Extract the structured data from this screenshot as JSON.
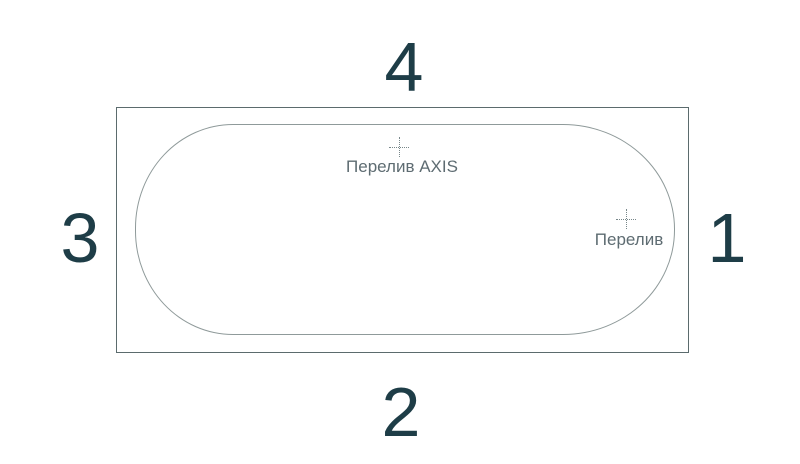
{
  "diagram": {
    "title": "bathtub top view with overflow positions",
    "sides": {
      "top": "4",
      "right": "1",
      "bottom": "2",
      "left": "3"
    },
    "markers": {
      "axis": {
        "label": "Перелив AXIS"
      },
      "standard": {
        "label": "Перелив"
      }
    },
    "colors": {
      "background": "#ffffff",
      "rim_outline": "#5b6b6d",
      "basin_outline": "#8f9a9a",
      "side_number": "#1e3d47",
      "marker_label": "#5e6c72",
      "crosshair": "#78878a"
    }
  }
}
